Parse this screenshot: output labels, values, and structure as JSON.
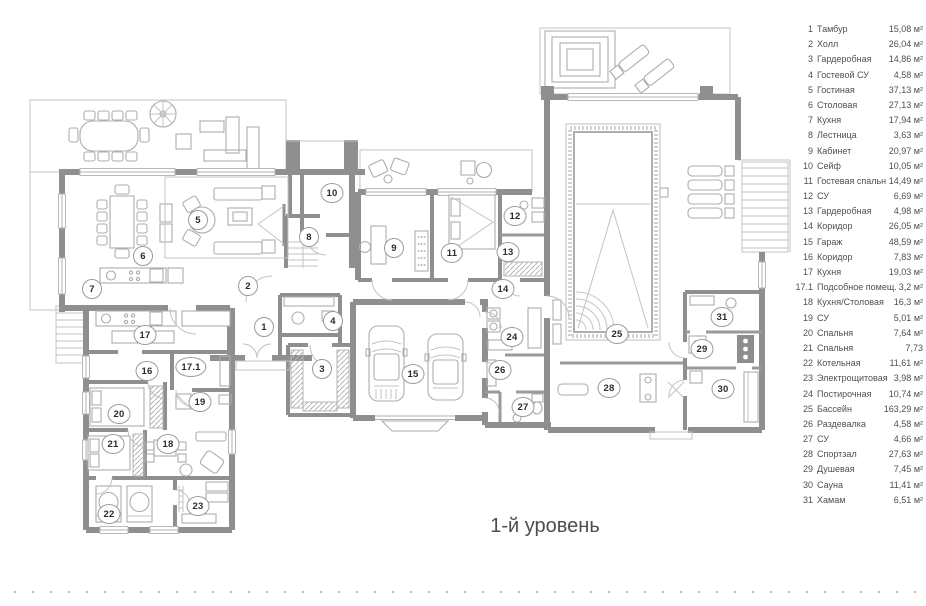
{
  "caption": "1-й уровень",
  "colors": {
    "wall": "#8f8f8f",
    "hatch": "#c9c9c9",
    "furniture_line": "#adadad",
    "text": "#4f4f4f"
  },
  "legend": {
    "items": [
      {
        "num": "1",
        "name": "Тамбур",
        "area": "15,08 м²"
      },
      {
        "num": "2",
        "name": "Холл",
        "area": "26,04 м²"
      },
      {
        "num": "3",
        "name": "Гардеробная",
        "area": "14,86 м²"
      },
      {
        "num": "4",
        "name": "Гостевой СУ",
        "area": "4,58 м²"
      },
      {
        "num": "5",
        "name": "Гостиная",
        "area": "37,13 м²"
      },
      {
        "num": "6",
        "name": "Столовая",
        "area": "27,13 м²"
      },
      {
        "num": "7",
        "name": "Кухня",
        "area": "17,94 м²"
      },
      {
        "num": "8",
        "name": "Лестница",
        "area": "3,63 м²"
      },
      {
        "num": "9",
        "name": "Кабинет",
        "area": "20,97 м²"
      },
      {
        "num": "10",
        "name": "Сейф",
        "area": "10,05 м²"
      },
      {
        "num": "11",
        "name": "Гостевая спальня",
        "area": "14,49 м²"
      },
      {
        "num": "12",
        "name": "СУ",
        "area": "6,69 м²"
      },
      {
        "num": "13",
        "name": "Гардеробная",
        "area": "4,98 м²"
      },
      {
        "num": "14",
        "name": "Коридор",
        "area": "26,05 м²"
      },
      {
        "num": "15",
        "name": "Гараж",
        "area": "48,59 м²"
      },
      {
        "num": "16",
        "name": "Коридор",
        "area": "7,83 м²"
      },
      {
        "num": "17",
        "name": "Кухня",
        "area": "19,03 м²"
      },
      {
        "num": "17.1",
        "name": "Подсобное помещ.",
        "area": "3,2 м²"
      },
      {
        "num": "18",
        "name": "Кухня/Столовая",
        "area": "16,3 м²"
      },
      {
        "num": "19",
        "name": "СУ",
        "area": "5,01 м²"
      },
      {
        "num": "20",
        "name": "Спальня",
        "area": "7,64 м²"
      },
      {
        "num": "21",
        "name": "Спальня",
        "area": "7,73"
      },
      {
        "num": "22",
        "name": "Котельная",
        "area": "11,61 м²"
      },
      {
        "num": "23",
        "name": "Электрощитовая",
        "area": "3,98 м²"
      },
      {
        "num": "24",
        "name": "Постирочная",
        "area": "10,74 м²"
      },
      {
        "num": "25",
        "name": "Бассейн",
        "area": "163,29 м²"
      },
      {
        "num": "26",
        "name": "Раздевалка",
        "area": "4,58 м²"
      },
      {
        "num": "27",
        "name": "СУ",
        "area": "4,66 м²"
      },
      {
        "num": "28",
        "name": "Спортзал",
        "area": "27,63 м²"
      },
      {
        "num": "29",
        "name": "Душевая",
        "area": "7,45 м²"
      },
      {
        "num": "30",
        "name": "Сауна",
        "area": "11,41 м²"
      },
      {
        "num": "31",
        "name": "Хамам",
        "area": "6,51 м²"
      }
    ]
  },
  "plan": {
    "rooms": [
      {
        "num": "1",
        "x": 264,
        "y": 327
      },
      {
        "num": "2",
        "x": 248,
        "y": 286
      },
      {
        "num": "3",
        "x": 322,
        "y": 369
      },
      {
        "num": "4",
        "x": 333,
        "y": 321
      },
      {
        "num": "5",
        "x": 198,
        "y": 220
      },
      {
        "num": "6",
        "x": 143,
        "y": 256
      },
      {
        "num": "7",
        "x": 92,
        "y": 289
      },
      {
        "num": "8",
        "x": 309,
        "y": 237
      },
      {
        "num": "9",
        "x": 394,
        "y": 248
      },
      {
        "num": "10",
        "x": 332,
        "y": 193
      },
      {
        "num": "11",
        "x": 452,
        "y": 253
      },
      {
        "num": "12",
        "x": 515,
        "y": 216
      },
      {
        "num": "13",
        "x": 508,
        "y": 252
      },
      {
        "num": "14",
        "x": 503,
        "y": 289
      },
      {
        "num": "15",
        "x": 413,
        "y": 374
      },
      {
        "num": "16",
        "x": 147,
        "y": 371
      },
      {
        "num": "17",
        "x": 145,
        "y": 335
      },
      {
        "num": "17.1",
        "x": 191,
        "y": 367
      },
      {
        "num": "18",
        "x": 168,
        "y": 444
      },
      {
        "num": "19",
        "x": 200,
        "y": 402
      },
      {
        "num": "20",
        "x": 119,
        "y": 414
      },
      {
        "num": "21",
        "x": 113,
        "y": 444
      },
      {
        "num": "22",
        "x": 109,
        "y": 514
      },
      {
        "num": "23",
        "x": 198,
        "y": 506
      },
      {
        "num": "24",
        "x": 512,
        "y": 337
      },
      {
        "num": "25",
        "x": 617,
        "y": 334
      },
      {
        "num": "26",
        "x": 500,
        "y": 370
      },
      {
        "num": "27",
        "x": 523,
        "y": 407
      },
      {
        "num": "28",
        "x": 609,
        "y": 388
      },
      {
        "num": "29",
        "x": 702,
        "y": 349
      },
      {
        "num": "30",
        "x": 723,
        "y": 389
      },
      {
        "num": "31",
        "x": 722,
        "y": 317
      }
    ]
  }
}
